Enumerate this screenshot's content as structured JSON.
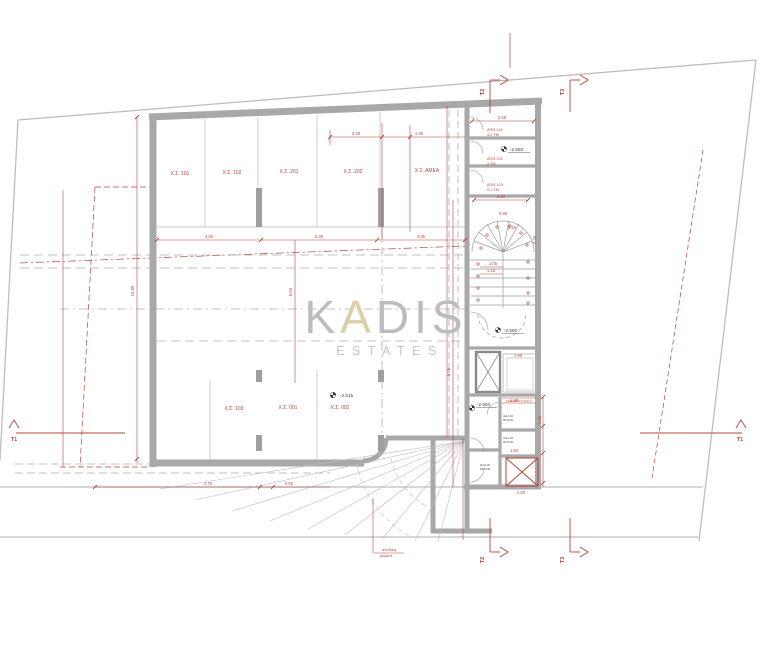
{
  "watermark": {
    "k": "K",
    "a": "A",
    "dis": "DIS",
    "estates": "ESTATES"
  },
  "parking": {
    "p101": "Χ.Σ. 101",
    "p102": "Χ.Σ. 102",
    "p201": "Χ.Σ. 201",
    "p202": "Χ.Σ. 202",
    "pamea": "Χ.Σ. ΑΜΕΑ",
    "p103": "Χ.Σ. 103",
    "p001": "Χ.Σ. 001",
    "p002": "Χ.Σ. 002"
  },
  "storage": {
    "r101": "ΑΠΘ-101",
    "r101a": "4.2 ΤΜ",
    "r102": "ΑΠΘ-102",
    "r102a": "4 ΤΜ",
    "r103": "ΑΠΘ-103",
    "r103a": "5.1 ΤΜ"
  },
  "levels": {
    "stair": "-2.500",
    "lobby": "-2.500",
    "store": "-2.500",
    "hall": "-2.515"
  },
  "door_tags": {
    "t1a": "ΘΑ2.00",
    "t1b": "80Χ240",
    "t2a": "ΘΑ2.00",
    "t2b": "80Χ240",
    "t3a": "ΘΑ2.00",
    "t3b": "80Χ240"
  },
  "labels": {
    "machine_room": "ΜΗΧΑΝΟΣΤΑΣΙΟ",
    "ramp1": "ανοδική",
    "ramp2": "ράμπα"
  },
  "sections": {
    "t1": "Τ1",
    "t2": "Τ2",
    "t3": "Τ3"
  },
  "dims": {
    "d240": "2.40",
    "d130": "1.30",
    "d480": "4.80",
    "d535": "5.35",
    "d405": "4.05",
    "d265": "2.65",
    "d250": "2.50",
    "d085": "0.85",
    "d010": "0.10",
    "d105": "1.05",
    "d110": "1.10",
    "d025": "0.25",
    "d190a": "1.90",
    "d180": "1.80",
    "d190b": "1.90",
    "d150a": "1.50",
    "d150b": "1.50",
    "d475": "4.75",
    "d060": "0.60",
    "d1580": "15.80",
    "d660": "6.60",
    "d555": "5.55"
  },
  "colors": {
    "dimension_red": "#b5453b",
    "wall_gray": "#a8a8a8",
    "boundary_gray": "#bdbdbd",
    "watermark_gray": "#bcbcbc",
    "watermark_accent": "#dccfa8"
  }
}
